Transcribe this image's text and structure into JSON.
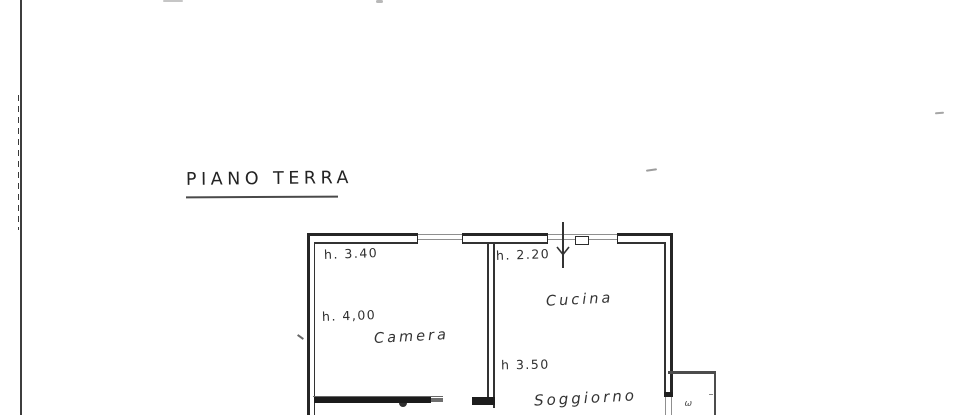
{
  "document": {
    "type": "scanned floor plan drawing",
    "title": "PIANO TERRA"
  },
  "plan": {
    "rooms": {
      "camera": "Camera",
      "cucina": "Cucina",
      "soggiorno": "Soggiorno"
    },
    "height_labels": {
      "camera_window": "h. 3.40",
      "camera_main": "h. 4,00",
      "cucina_window": "h. 2.20",
      "soggiorno_main": "h 3.50"
    },
    "balcony_mark": "ω"
  },
  "colors": {
    "paper": "#ffffff",
    "ink": "#262626",
    "mid_ink": "#4c4c4c",
    "light_ink": "#8f8f8f",
    "border_line": "#3d3d3d"
  }
}
